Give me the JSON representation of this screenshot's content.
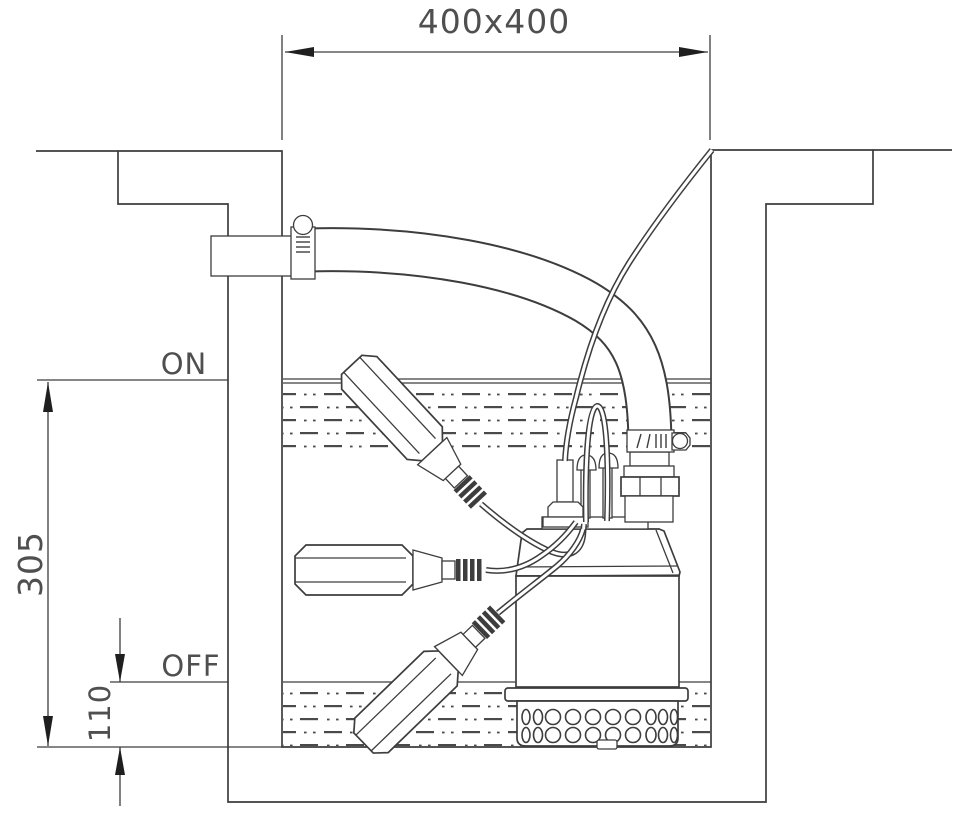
{
  "labels": {
    "opening_dimension": "400x400",
    "on_level": "ON",
    "off_level": "OFF",
    "on_height": "305",
    "off_height": "110"
  },
  "colors": {
    "line": "#3d3d3d",
    "label_text": "#4f4f4f",
    "background": "#ffffff"
  }
}
